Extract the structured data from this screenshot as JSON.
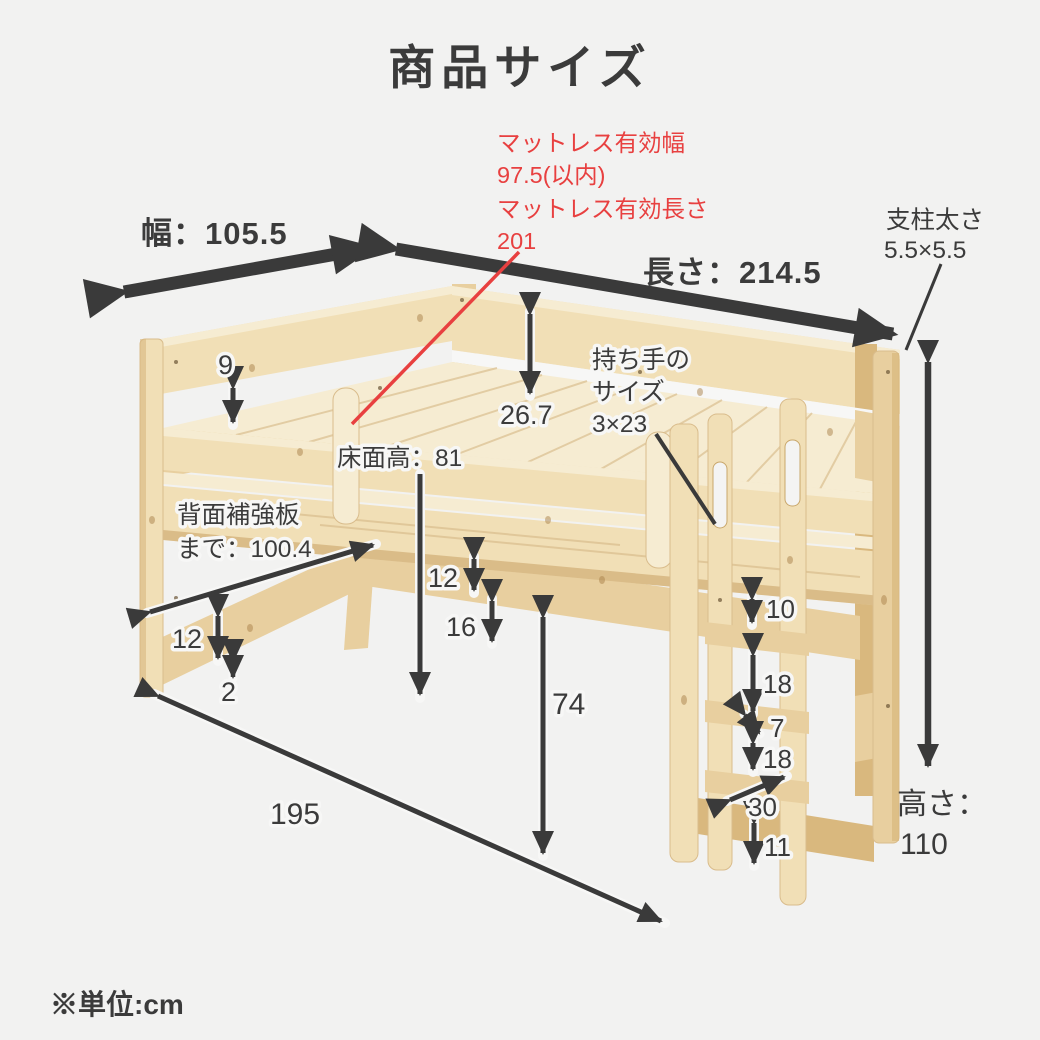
{
  "title": "商品サイズ",
  "unit_note": "※単位:cm",
  "colors": {
    "background": "#f2f2f1",
    "arrow": "#3a3a3a",
    "accent_red": "#e84040",
    "wood_light": "#f1dfb6",
    "wood_mid": "#e8cf9f",
    "wood_deep": "#d9b87e",
    "wood_pale": "#f6ecd2"
  },
  "dimensions": {
    "mattress_width_label": "マットレス有効幅",
    "mattress_width_value": "97.5(以内)",
    "mattress_length_label": "マットレス有効長さ",
    "mattress_length_value": "201",
    "width": "幅：105.5",
    "length": "長さ：214.5",
    "post_size_label": "支柱太さ",
    "post_size_value": "5.5×5.5",
    "handle_label_1": "持ち手の",
    "handle_label_2": "サイズ",
    "handle_size": "3×23",
    "guard_above_mattress": "9",
    "guard_height": "26.7",
    "deck_height": "床面高：81",
    "back_board_label": "背面補強板",
    "back_board_value": "まで：100.4",
    "back_rail_width_left": "12",
    "back_rail_gap_bottom": "2",
    "back_rail_width_mid": "12",
    "back_rail_clearance": "16",
    "under_bed_clearance": "74",
    "inner_length": "195",
    "ladder_top_gap": "10",
    "ladder_gap_1": "18",
    "ladder_rung_depth": "7",
    "ladder_gap_2": "18",
    "ladder_width": "30",
    "ladder_bottom_gap": "11",
    "height_label": "高さ：",
    "height_value": "110"
  }
}
